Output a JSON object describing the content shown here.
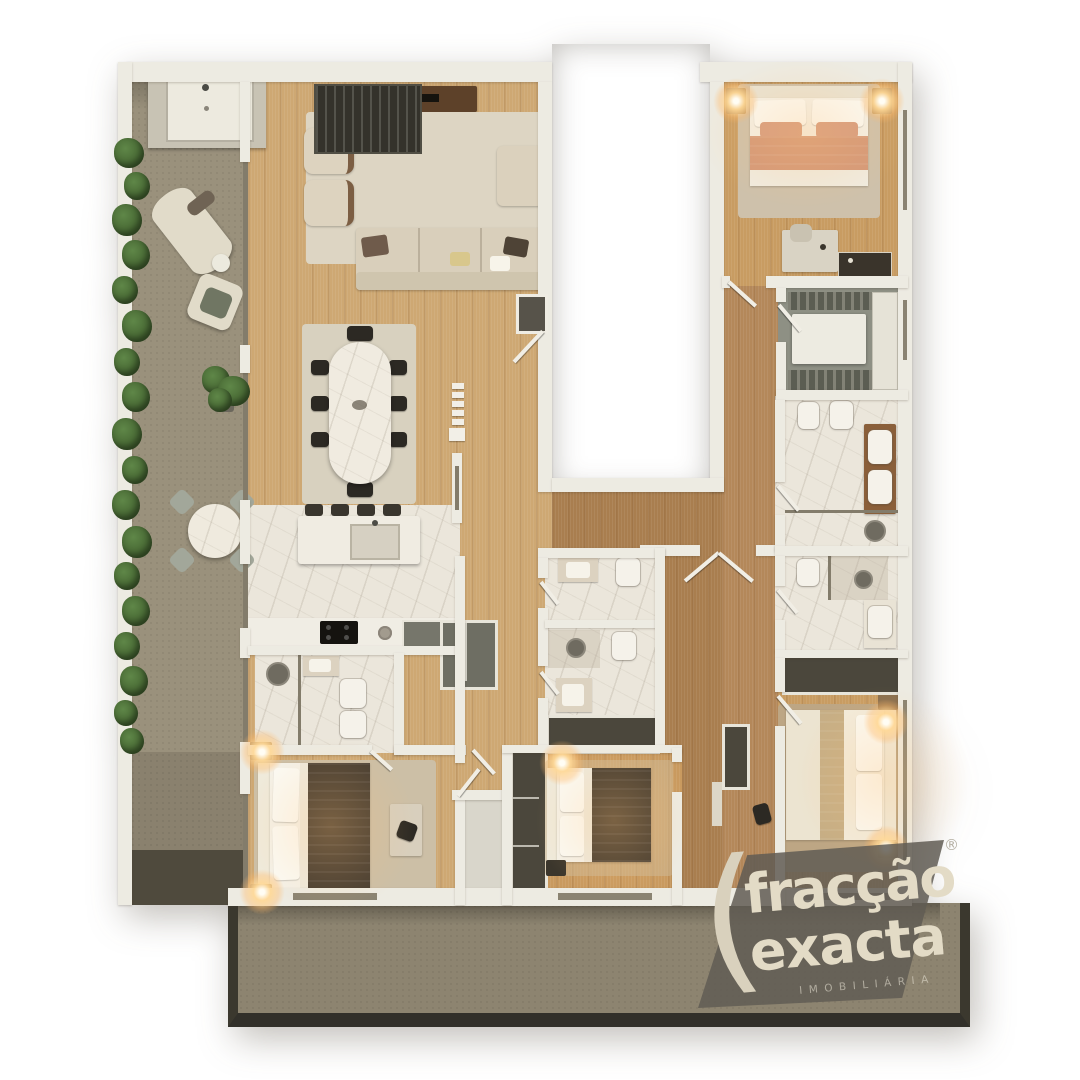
{
  "logo": {
    "paren": "(",
    "word1": "fracção",
    "accent": "´",
    "word2": "exacta",
    "tagline": "IMOBILIÁRIA",
    "registered": "®"
  },
  "scene": {
    "type": "3d-floor-plan-top-down-render",
    "rooms": [
      "terrace-left",
      "outdoor-kitchen",
      "living-room",
      "dining-area",
      "kitchen",
      "hall",
      "entry-vestibule",
      "bathroom-ensuite-1",
      "bedroom-1",
      "bathroom-center-a",
      "bathroom-center-b",
      "bedroom-2",
      "master-bedroom",
      "walk-in-closet",
      "master-bathroom",
      "bathroom-3",
      "bedroom-3",
      "corridor",
      "terrace-bottom",
      "building-core-void"
    ]
  },
  "palette": {
    "wall": "#edebe2",
    "wood_light": "#cea873",
    "wood_warm": "#c89c62",
    "wood_hall": "#a97e4f",
    "terrace": "#9a917c",
    "terrace_bottom_rim": "#33312a",
    "marble": "#ebe6db",
    "closet_floor": "#8e9084",
    "dark_unit": "#4b473c",
    "bed_dark": "#463c30",
    "bed_salmon": "#d49878",
    "hedge_green": "#4e7340",
    "lamp_glow": "#ffd896",
    "logo_bg": "rgba(96,92,83,0.85)",
    "logo_text": "#e3dbc6"
  }
}
